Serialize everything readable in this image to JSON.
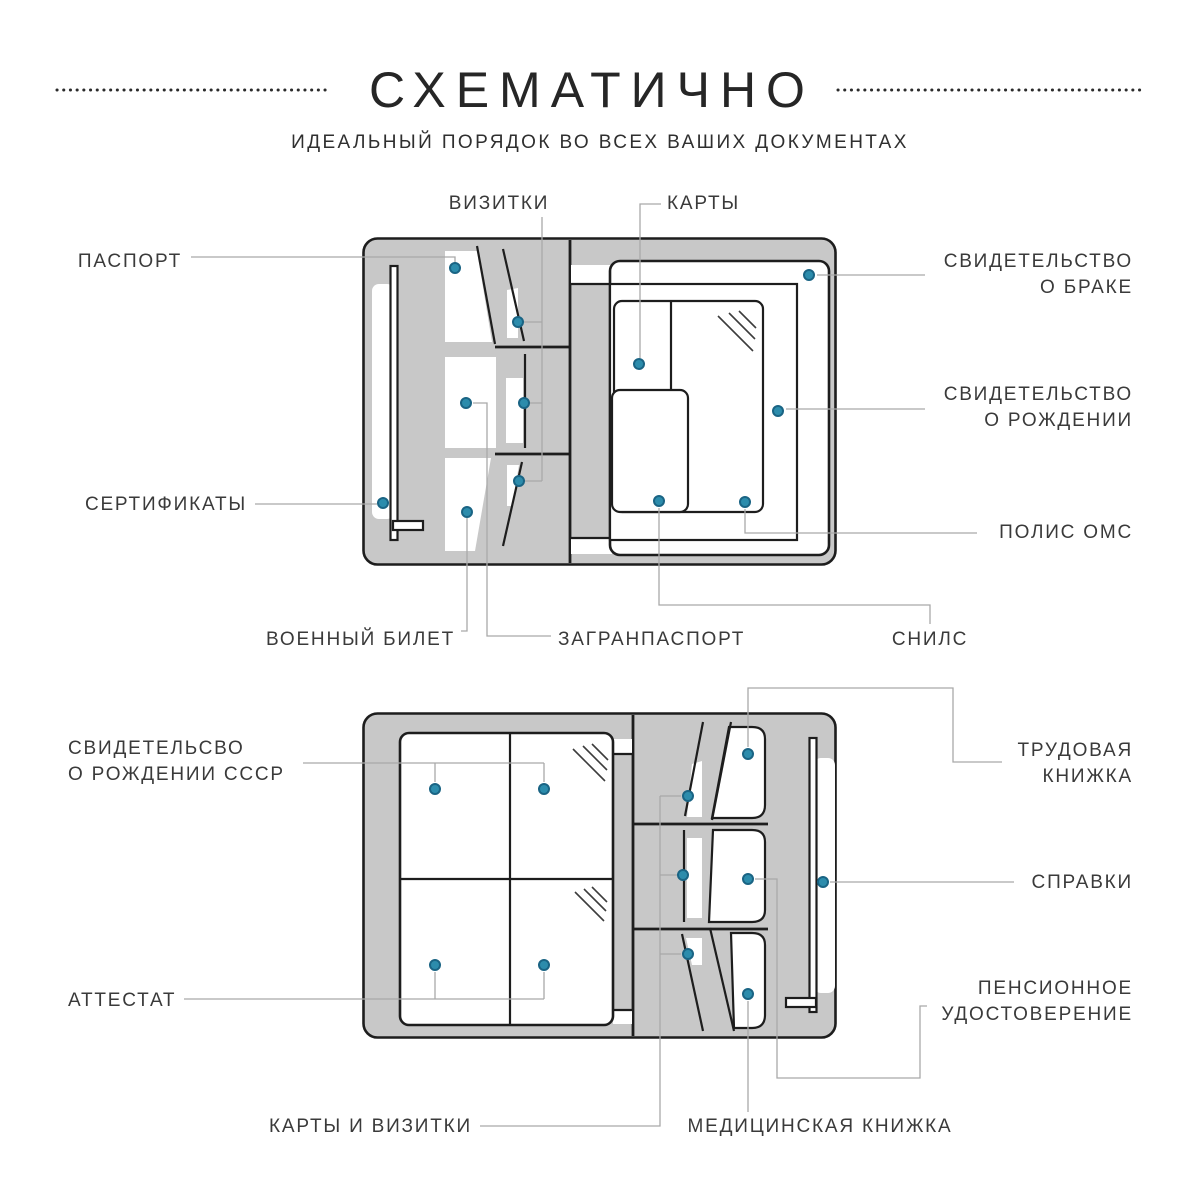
{
  "header": {
    "title": "СХЕМАТИЧНО",
    "subtitle": "ИДЕАЛЬНЫЙ ПОРЯДОК ВО ВСЕХ ВАШИХ ДОКУМЕНТАХ"
  },
  "colors": {
    "background": "#ffffff",
    "organizer_fill": "#c8c8c8",
    "outline": "#1d1d1d",
    "pocket_white": "#ffffff",
    "connector": "#a9a9a9",
    "dot_fill": "#2c8cac",
    "dot_stroke": "#1a6484",
    "label_text": "#3a3a3a"
  },
  "diagrams": [
    {
      "id": "top-organizer",
      "labels": [
        {
          "id": "vizitki",
          "lines": [
            "ВИЗИТКИ"
          ],
          "x": 499,
          "y": 204,
          "align": "center",
          "paths": [
            [
              [
                542,
                217
              ],
              [
                542,
                481
              ]
            ],
            [
              [
                518,
                322
              ],
              [
                542,
                322
              ]
            ],
            [
              [
                524,
                403
              ],
              [
                542,
                403
              ]
            ],
            [
              [
                519,
                481
              ],
              [
                542,
                481
              ]
            ]
          ],
          "dots": [
            [
              518,
              322
            ],
            [
              524,
              403
            ],
            [
              519,
              481
            ]
          ]
        },
        {
          "id": "karty",
          "lines": [
            "КАРТЫ"
          ],
          "x": 667,
          "y": 204,
          "align": "left",
          "paths": [
            [
              [
                661,
                204
              ],
              [
                640,
                204
              ],
              [
                640,
                358
              ]
            ]
          ],
          "dots": [
            [
              639,
              364
            ]
          ]
        },
        {
          "id": "pasport",
          "lines": [
            "ПАСПОРТ"
          ],
          "x": 182,
          "y": 262,
          "align": "right",
          "paths": [
            [
              [
                191,
                257
              ],
              [
                455,
                257
              ],
              [
                455,
                262
              ]
            ]
          ],
          "dots": [
            [
              455,
              268
            ]
          ]
        },
        {
          "id": "sertifikaty",
          "lines": [
            "СЕРТИФИКАТЫ"
          ],
          "x": 247,
          "y": 505,
          "align": "right",
          "paths": [
            [
              [
                255,
                504
              ],
              [
                377,
                504
              ]
            ]
          ],
          "dots": [
            [
              383,
              503
            ]
          ]
        },
        {
          "id": "svidetelstvo-o-brake",
          "lines": [
            "СВИДЕТЕЛЬСТВО",
            "О БРАКЕ"
          ],
          "x": 1133,
          "y": 262,
          "align": "right",
          "paths": [
            [
              [
                817,
                275
              ],
              [
                925,
                275
              ]
            ]
          ],
          "dots": [
            [
              809,
              275
            ]
          ]
        },
        {
          "id": "svidetelstvo-o-rozhdenii",
          "lines": [
            "СВИДЕТЕЛЬСТВО",
            "О РОЖДЕНИИ"
          ],
          "x": 1133,
          "y": 395,
          "align": "right",
          "paths": [
            [
              [
                786,
                409
              ],
              [
                925,
                409
              ]
            ]
          ],
          "dots": [
            [
              778,
              411
            ]
          ]
        },
        {
          "id": "polis-oms",
          "lines": [
            "ПОЛИС ОМС"
          ],
          "x": 1133,
          "y": 533,
          "align": "right",
          "paths": [
            [
              [
                745,
                509
              ],
              [
                745,
                533
              ],
              [
                977,
                533
              ]
            ]
          ],
          "dots": [
            [
              745,
              502
            ]
          ]
        },
        {
          "id": "voennyi-bilet",
          "lines": [
            "ВОЕННЫЙ БИЛЕТ"
          ],
          "x": 455,
          "y": 640,
          "align": "right",
          "paths": [
            [
              [
                467,
                518
              ],
              [
                467,
                631
              ],
              [
                461,
                631
              ]
            ]
          ],
          "dots": [
            [
              467,
              512
            ]
          ]
        },
        {
          "id": "zagranpasport",
          "lines": [
            "ЗАГРАНПАСПОРТ"
          ],
          "x": 558,
          "y": 640,
          "align": "left",
          "paths": [
            [
              [
                473,
                403
              ],
              [
                487,
                403
              ],
              [
                487,
                636
              ],
              [
                551,
                636
              ]
            ]
          ],
          "dots": [
            [
              466,
              403
            ]
          ]
        },
        {
          "id": "snils",
          "lines": [
            "СНИЛС"
          ],
          "x": 930,
          "y": 640,
          "align": "center",
          "paths": [
            [
              [
                659,
                508
              ],
              [
                659,
                605
              ],
              [
                930,
                605
              ],
              [
                930,
                624
              ]
            ]
          ],
          "dots": [
            [
              659,
              501
            ]
          ]
        }
      ]
    },
    {
      "id": "bottom-organizer",
      "labels": [
        {
          "id": "svidetelsvo-o-rozhdenii-sssr",
          "lines": [
            "СВИДЕТЕЛЬСВО",
            "О РОЖДЕНИИ СССР"
          ],
          "x": 68,
          "y": 749,
          "align": "left",
          "paths": [
            [
              [
                303,
                763
              ],
              [
                544,
                763
              ]
            ],
            [
              [
                435,
                763
              ],
              [
                435,
                782
              ]
            ],
            [
              [
                544,
                763
              ],
              [
                544,
                782
              ]
            ]
          ],
          "dots": [
            [
              435,
              789
            ],
            [
              544,
              789
            ]
          ]
        },
        {
          "id": "attestat",
          "lines": [
            "АТТЕСТАТ"
          ],
          "x": 68,
          "y": 1001,
          "align": "left",
          "paths": [
            [
              [
                184,
                999
              ],
              [
                544,
                999
              ]
            ],
            [
              [
                435,
                999
              ],
              [
                435,
                972
              ]
            ],
            [
              [
                544,
                999
              ],
              [
                544,
                972
              ]
            ]
          ],
          "dots": [
            [
              435,
              965
            ],
            [
              544,
              965
            ]
          ]
        },
        {
          "id": "trudovaya-knizhka",
          "lines": [
            "ТРУДОВАЯ",
            "КНИЖКА"
          ],
          "x": 1133,
          "y": 751,
          "align": "right",
          "paths": [
            [
              [
                748,
                747
              ],
              [
                748,
                688
              ],
              [
                953,
                688
              ],
              [
                953,
                762
              ],
              [
                1002,
                762
              ]
            ]
          ],
          "dots": [
            [
              748,
              754
            ]
          ]
        },
        {
          "id": "spravki",
          "lines": [
            "СПРАВКИ"
          ],
          "x": 1133,
          "y": 883,
          "align": "right",
          "paths": [
            [
              [
                830,
                882
              ],
              [
                1014,
                882
              ]
            ]
          ],
          "dots": [
            [
              823,
              882
            ]
          ]
        },
        {
          "id": "pensionnoe-udostoverenie",
          "lines": [
            "ПЕНСИОННОЕ",
            "УДОСТОВЕРЕНИЕ"
          ],
          "x": 1133,
          "y": 989,
          "align": "right",
          "paths": [
            [
              [
                755,
                879
              ],
              [
                777,
                879
              ],
              [
                777,
                1078
              ],
              [
                920,
                1078
              ],
              [
                920,
                1006
              ],
              [
                927,
                1006
              ]
            ]
          ],
          "dots": [
            [
              748,
              879
            ]
          ]
        },
        {
          "id": "karty-i-vizitki",
          "lines": [
            "КАРТЫ И ВИЗИТКИ"
          ],
          "x": 472,
          "y": 1127,
          "align": "right",
          "paths": [
            [
              [
                480,
                1126
              ],
              [
                660,
                1126
              ],
              [
                660,
                796
              ]
            ],
            [
              [
                660,
                796
              ],
              [
                681,
                796
              ]
            ],
            [
              [
                660,
                875
              ],
              [
                677,
                875
              ]
            ],
            [
              [
                660,
                954
              ],
              [
                681,
                954
              ]
            ]
          ],
          "dots": [
            [
              688,
              796
            ],
            [
              683,
              875
            ],
            [
              688,
              954
            ]
          ]
        },
        {
          "id": "meditsinskaya-knizhka",
          "lines": [
            "МЕДИЦИНСКАЯ КНИЖКА"
          ],
          "x": 820,
          "y": 1127,
          "align": "center",
          "paths": [
            [
              [
                748,
                1001
              ],
              [
                748,
                1112
              ]
            ]
          ],
          "dots": [
            [
              748,
              994
            ]
          ]
        }
      ]
    }
  ]
}
